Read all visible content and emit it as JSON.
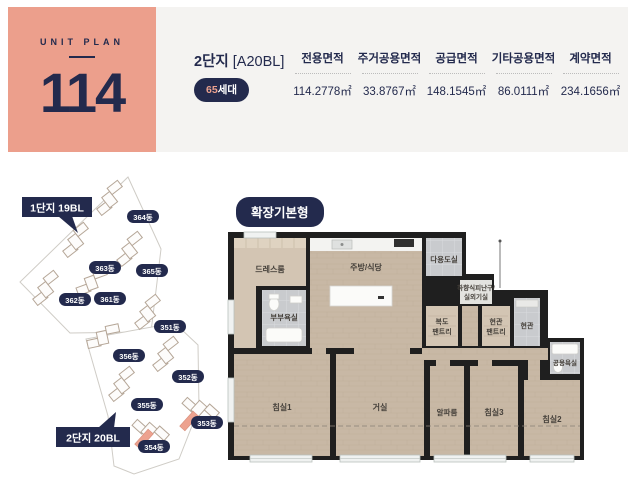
{
  "unit_card": {
    "eyebrow": "UNIT PLAN",
    "number": "114"
  },
  "summary": {
    "complex_name": "2단지",
    "block_code": "[A20BL]",
    "households_count": "65",
    "households_unit": "세대",
    "columns": [
      {
        "label": "전용면적",
        "value": "114.2778㎡"
      },
      {
        "label": "주거공용면적",
        "value": "33.8767㎡"
      },
      {
        "label": "공급면적",
        "value": "148.1545㎡"
      },
      {
        "label": "기타공용면적",
        "value": "86.0111㎡"
      },
      {
        "label": "계약면적",
        "value": "234.1656㎡"
      }
    ]
  },
  "site_plan": {
    "complex1_label": "1단지 19BL",
    "complex2_label": "2단지 20BL",
    "buildings": [
      "364동",
      "363동",
      "365동",
      "362동",
      "361동",
      "351동",
      "356동",
      "352동",
      "355동",
      "353동",
      "354동"
    ]
  },
  "floor_plan": {
    "type_tag": "확장기본형",
    "rooms": {
      "dress_room": "드레스룸",
      "kitchen_dining": "주방/식당",
      "utility_room": "다용도실",
      "escape_line1": "하향식피난구/",
      "escape_line2": "실외기실",
      "master_bathroom": "부부욕실",
      "hall_pantry_line1": "복도",
      "hall_pantry_line2": "팬트리",
      "entry_pantry_line1": "현관",
      "entry_pantry_line2": "팬트리",
      "entrance": "현관",
      "common_bathroom": "공용욕실",
      "bedroom1": "침실1",
      "living_room": "거실",
      "alpha_room": "알파룸",
      "bedroom3": "침실3",
      "bedroom2": "침실2"
    }
  },
  "colors": {
    "accent_coral": "#ec9f8c",
    "navy": "#232a4d",
    "panel_gray": "#f4f3f1"
  }
}
